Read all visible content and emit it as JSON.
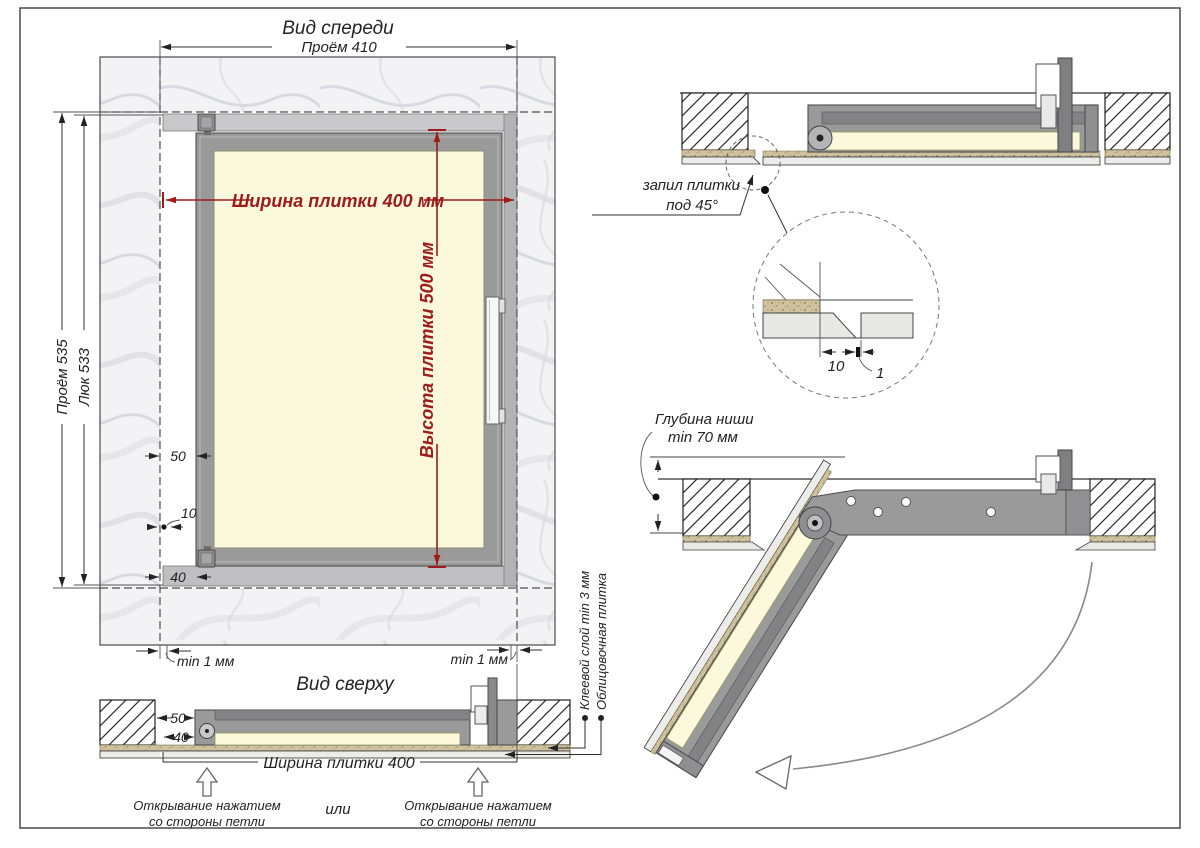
{
  "page": {
    "border_color": "#4a4a4a",
    "background": "#ffffff"
  },
  "colors": {
    "dim_red": "#9e1b1b",
    "frame_gray": "#9a9a9a",
    "tile_cream": "#fbf8dc"
  },
  "front_view": {
    "title": "Вид спереди",
    "dim_opening_width": "Проём 410",
    "dim_opening_height": "Проём 535",
    "dim_hatch_height": "Люк 533",
    "dim_tile_width": "Ширина плитки 400 мм",
    "dim_tile_height": "Высота плитки 500 мм",
    "dim_hinge_offset": "50",
    "dim_gap_10": "10",
    "dim_bottom_40": "40",
    "gap_min_left": "min 1 мм",
    "gap_min_right": "min 1 мм"
  },
  "top_view": {
    "title": "Вид сверху",
    "dim_50": "50",
    "dim_40": "40",
    "dim_tile_width": "Ширина плитки 400",
    "open_left_line1": "Открывание нажатием",
    "open_left_line2": "со стороны петли",
    "or_label": "или",
    "open_right_line1": "Открывание нажатием",
    "open_right_line2": "со стороны петли",
    "label_glue": "Клеевой слой min 3 мм",
    "label_tile": "Облицовочная плитка"
  },
  "section_view": {
    "label_cut_line1": "запил плитки",
    "label_cut_line2": "под 45°",
    "detail_dim_width": "10",
    "detail_dim_gap": "1"
  },
  "open_view": {
    "label_niche_line1": "Глубина ниши",
    "label_niche_line2": "min 70 мм"
  }
}
